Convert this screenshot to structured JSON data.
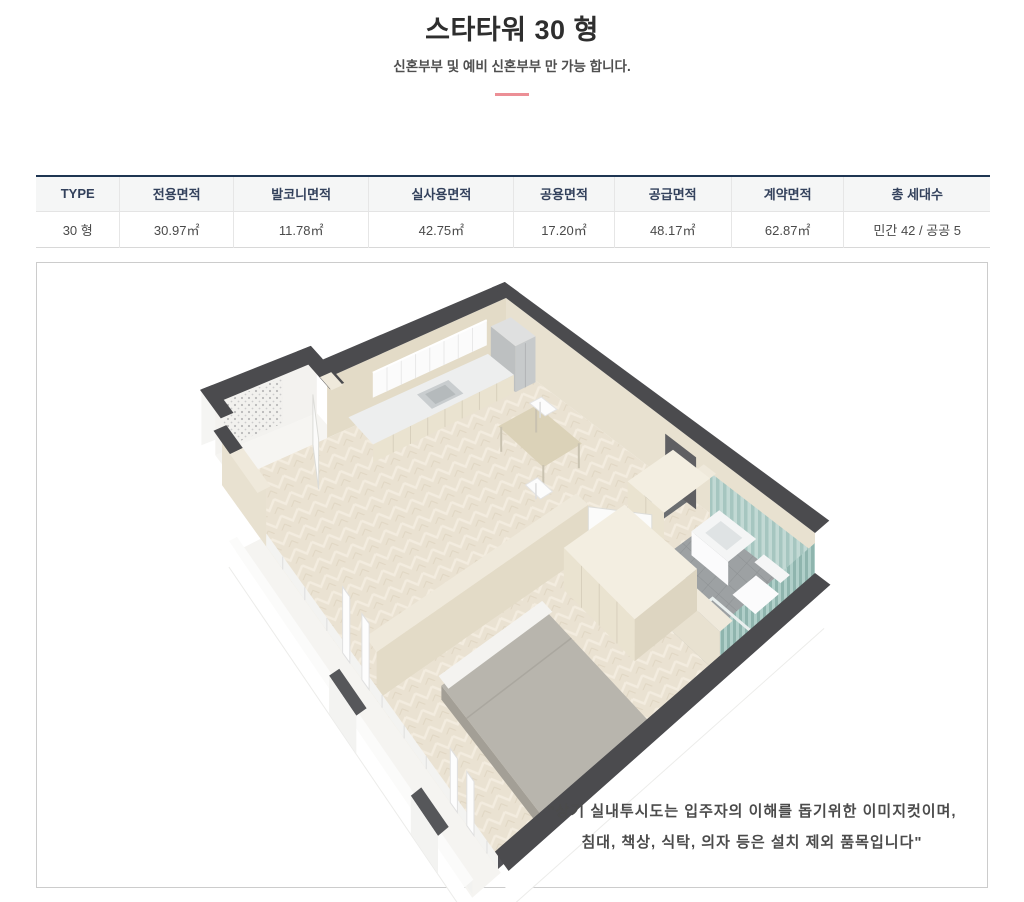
{
  "header": {
    "title": "스타타워 30 형",
    "subtitle": "신혼부부 및 예비 신혼부부 만 가능 합니다.",
    "divider_color": "#ec8f96"
  },
  "area_table": {
    "accent_border": "#1e3552",
    "columns": [
      "TYPE",
      "전용면적",
      "발코니면적",
      "실사용면적",
      "공용면적",
      "공급면적",
      "계약면적",
      "총 세대수"
    ],
    "row": {
      "type": "30 형",
      "exclusive_area": "30.97㎡",
      "balcony_area": "11.78㎡",
      "actual_use_area": "42.75㎡",
      "common_area": "17.20㎡",
      "supply_area": "48.17㎡",
      "contract_area": "62.87㎡",
      "households": "민간 42 / 공공 5"
    }
  },
  "floorplan": {
    "disclaimer": {
      "line1": "\"상기 실내투시도는 입주자의 이해를 돕기위한 이미지컷이며,",
      "line2": "침대, 책상, 식탁, 의자 등은 설치 제외 품목입니다\""
    },
    "colors": {
      "wall_dark": "#4b4b4e",
      "wall_face": "#e8e1d0",
      "wall_face_dim": "#e3dbc7",
      "wall_cap": "#efe9db",
      "floor": "#eae2d2",
      "floor_line": "#f3ecdf",
      "balcony_floor": "#f5f4f1",
      "white_wall": "#f5f5f3",
      "frame_line": "#dedede",
      "hall_floor": "#6b6e71",
      "opening": "#5f5f62",
      "bath_floor": "#9da1a3",
      "bath_grid": "#8d9193",
      "teal": "#a6c6c0",
      "teal_light": "#c2d9d4",
      "teal_dark": "#8fb5ae",
      "fixture": "#fbfbfc",
      "cabinet": "#eae3d0",
      "cabinet_seam": "#d8d0bd",
      "counter": "#edeeee",
      "upper_cabinet": "#fbfbfb",
      "appliance": "#c7cacb",
      "appliance_top": "#dfe0e0",
      "sink": "#b5babc",
      "sink_rim": "#c9cdcf",
      "table_top": "#dbd2b8",
      "table_leg": "#c9c2b0",
      "stool": "#fcfcfc",
      "wardrobe_top": "#f3eee1",
      "wardrobe_side": "#ddd5c1",
      "bed": "#b8b5ad",
      "bed_side": "#a39f96",
      "bed_end": "#9b9890",
      "bed_head": "#f4f3f0",
      "door": "#fbfbfa",
      "door_edge": "#dcdcd8",
      "post_dark": "#56575a"
    }
  }
}
